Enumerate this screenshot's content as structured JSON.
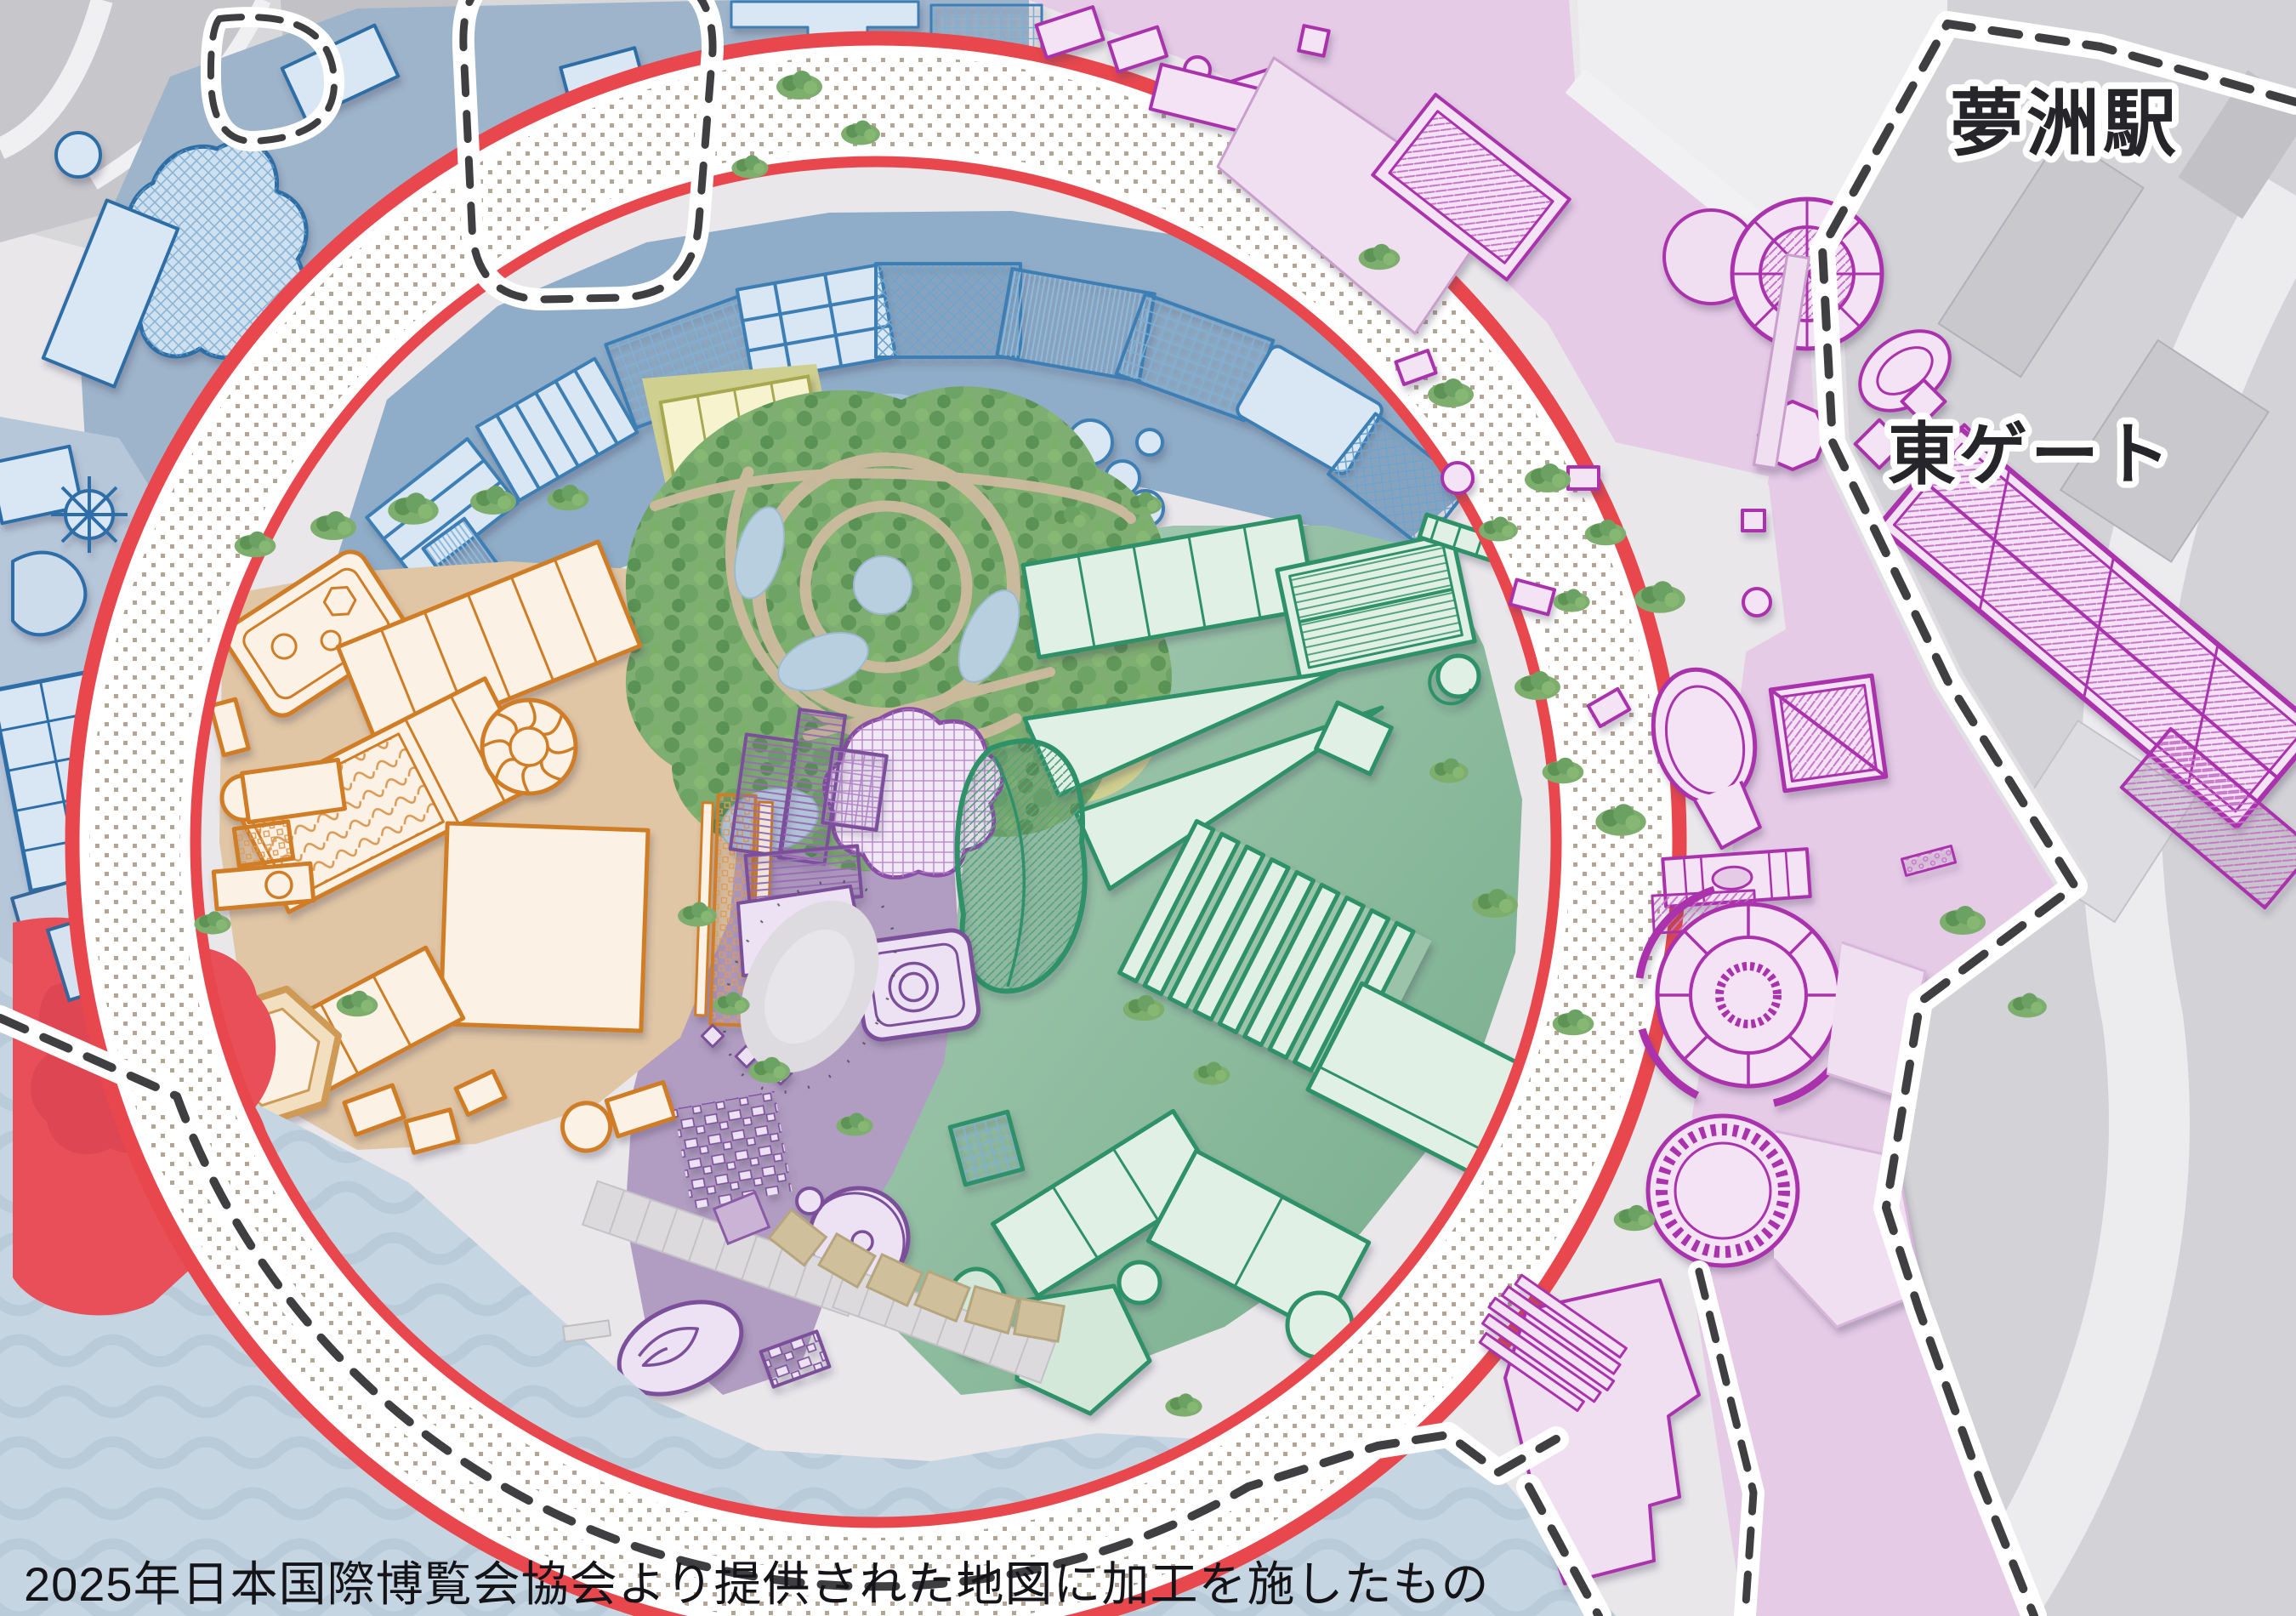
{
  "map": {
    "region": "expo-2025-yumeshima-site-map",
    "labels": {
      "station": "夢洲駅",
      "east_gate": "東ゲート",
      "caption": "2025年日本国際博覧会協会より提供された地図に加工を施したもの"
    },
    "colors": {
      "ring_red": "#e8474d",
      "ring_band": "#ffffff",
      "ring_dots": "#b3a593",
      "water": "#c5d6e2",
      "wave": "#b7c8d6",
      "land": "#e9e7ea",
      "road_gray": "#d8d7da",
      "zone_north_ground": "#8fadc8",
      "zone_north_building": "#d9e7f4",
      "zone_north_stroke": "#3c7fb5",
      "zone_west_ground": "#e0c6a4",
      "zone_west_building": "#fbf1e4",
      "zone_west_stroke": "#d07d28",
      "zone_east_ground": "#9ac3a9",
      "zone_east_building": "#e0f0e5",
      "zone_east_stroke": "#2f9168",
      "zone_signature_ground": "#b29dc2",
      "zone_signature_building": "#ece2f3",
      "zone_signature_stroke": "#7b4f9b",
      "zone_outside_east_ground": "#e5cbe6",
      "zone_outside_east_building": "#f3e3f4",
      "zone_outside_east_stroke": "#ab32ad",
      "zone_yellow_ground": "#cfcf8f",
      "zone_yellow_building": "#f7f3cf",
      "zone_yellow_stroke": "#a8a84f",
      "forest_green": "#7fae73",
      "path_tan": "#cdbb9f",
      "pond_blue": "#b8cfe0",
      "highlight_red": "#e84f58",
      "boundary_dash": "#3f3e41",
      "label_text": "#26262a",
      "label_halo": "#ffffff"
    },
    "zones": [
      {
        "id": "zone-north-pavilions"
      },
      {
        "id": "zone-west-pavilions"
      },
      {
        "id": "zone-east-pavilions"
      },
      {
        "id": "zone-signature-pavilions"
      },
      {
        "id": "zone-east-outside-pavilions"
      },
      {
        "id": "forest-of-tranquility"
      },
      {
        "id": "grand-ring"
      },
      {
        "id": "water"
      }
    ]
  }
}
